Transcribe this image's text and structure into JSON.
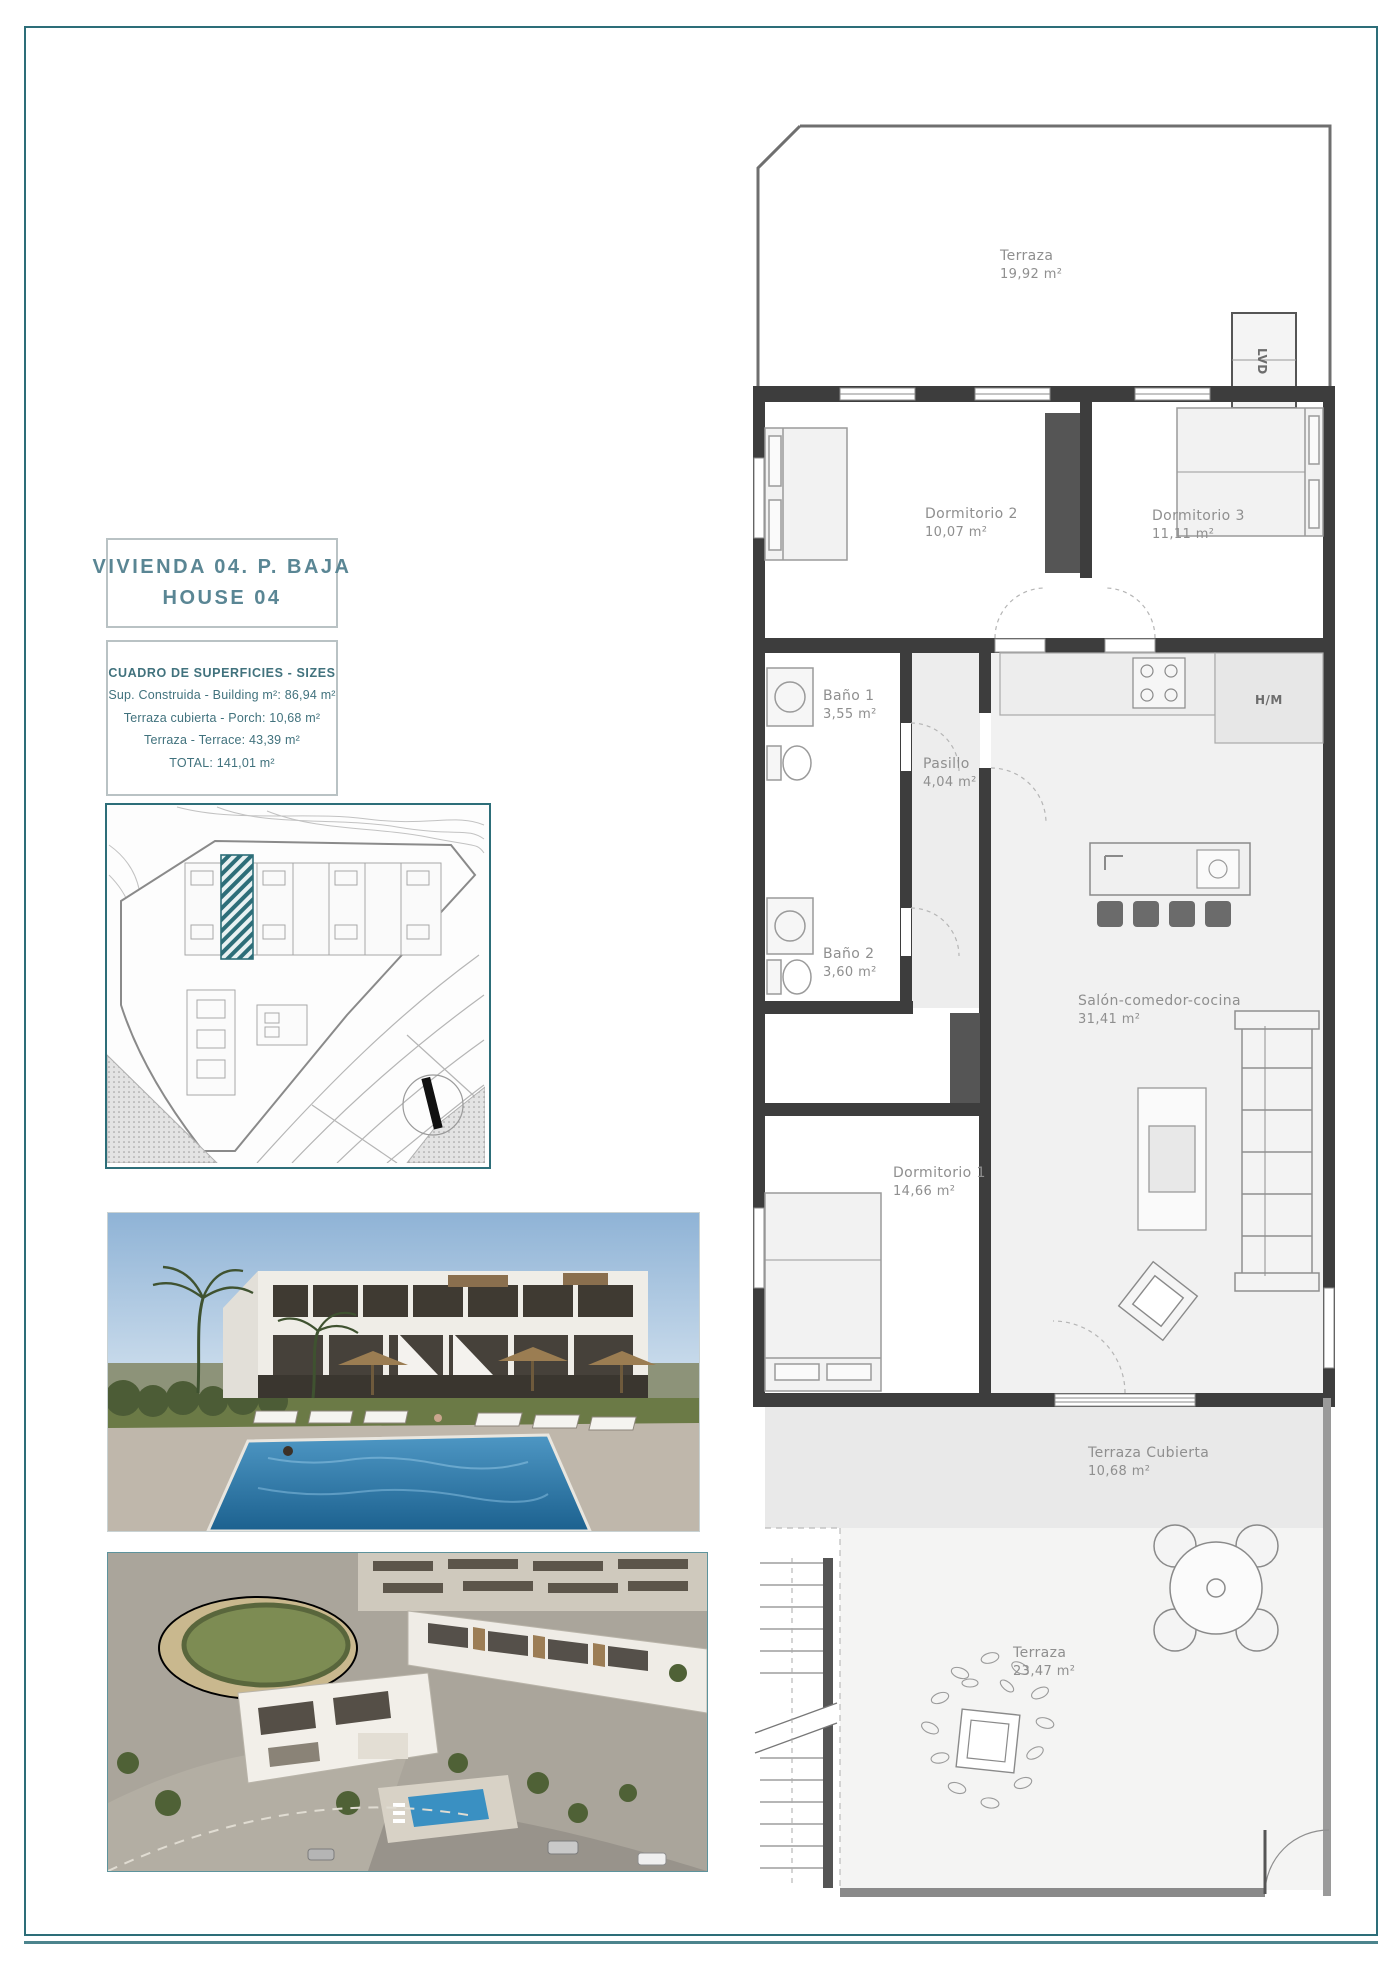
{
  "page": {
    "border_color": "#2d6e79"
  },
  "header": {
    "title_line1": "VIVIENDA 04. P. BAJA",
    "title_line2": "HOUSE 04"
  },
  "sizes": {
    "title": "CUADRO DE SUPERFICIES  - SIZES",
    "built": "Sup. Construida  - Building m²: 86,94 m²",
    "porch": "Terraza cubierta  - Porch: 10,68 m²",
    "terrace": "Terraza - Terrace: 43,39 m²",
    "total": "TOTAL:  141,01 m²"
  },
  "floor_plan": {
    "rooms": {
      "terrace_top": {
        "name": "Terraza",
        "area": "19,92 m²"
      },
      "bedroom2": {
        "name": "Dormitorio 2",
        "area": "10,07 m²"
      },
      "bedroom3": {
        "name": "Dormitorio 3",
        "area": "11,11 m²"
      },
      "bath1": {
        "name": "Baño 1",
        "area": "3,55 m²"
      },
      "hall": {
        "name": "Pasillo",
        "area": "4,04 m²"
      },
      "bath2": {
        "name": "Baño 2",
        "area": "3,60 m²"
      },
      "bedroom1": {
        "name": "Dormitorio 1",
        "area": "14,66 m²"
      },
      "living": {
        "name": "Salón-comedor-cocina",
        "area": "31,41 m²"
      },
      "covered_terrace": {
        "name": "Terraza Cubierta",
        "area": "10,68 m²"
      },
      "terrace_bottom": {
        "name": "Terraza",
        "area": "23,47 m²"
      }
    },
    "labels": {
      "laundry": "LVD",
      "tall_units": "H/M"
    }
  }
}
